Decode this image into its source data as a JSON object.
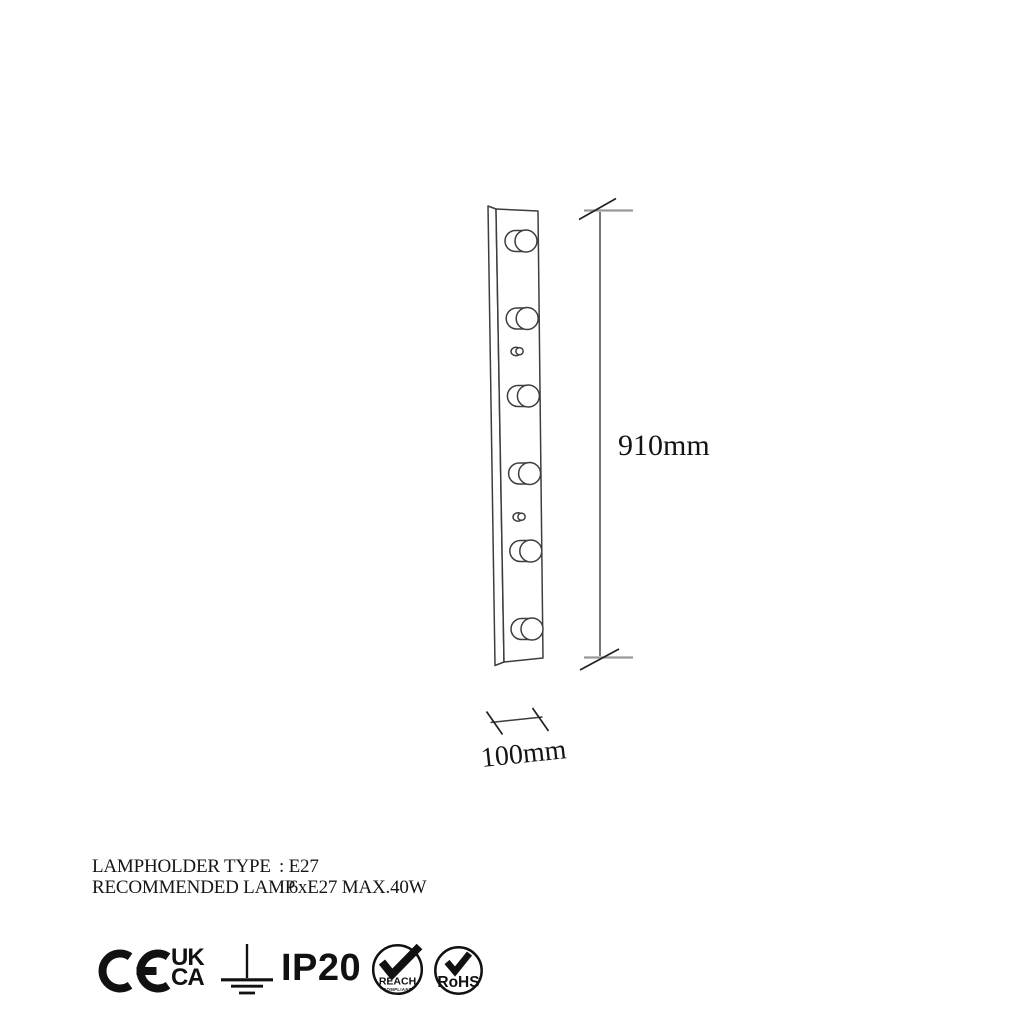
{
  "drawing": {
    "height_dim": "910mm",
    "width_dim": "100mm",
    "lamp_count": 6
  },
  "specs": {
    "rows": [
      {
        "label": "LAMPHOLDER TYPE",
        "value": ": E27"
      },
      {
        "label": "RECOMMENDED LAMP",
        "value": ": 6xE27 MAX.40W"
      }
    ]
  },
  "certs": {
    "ce": "CE",
    "ukca": {
      "line1": "UK",
      "line2": "CA"
    },
    "ip_rating": "IP20",
    "reach": {
      "label": "REACH",
      "sublabel": "COMPLIANT"
    },
    "rohs": {
      "label": "RoHS"
    }
  },
  "colors": {
    "ink": "#111111",
    "drawing_line": "#3d3d3d",
    "tick_gray": "#999999",
    "background": "#ffffff"
  }
}
